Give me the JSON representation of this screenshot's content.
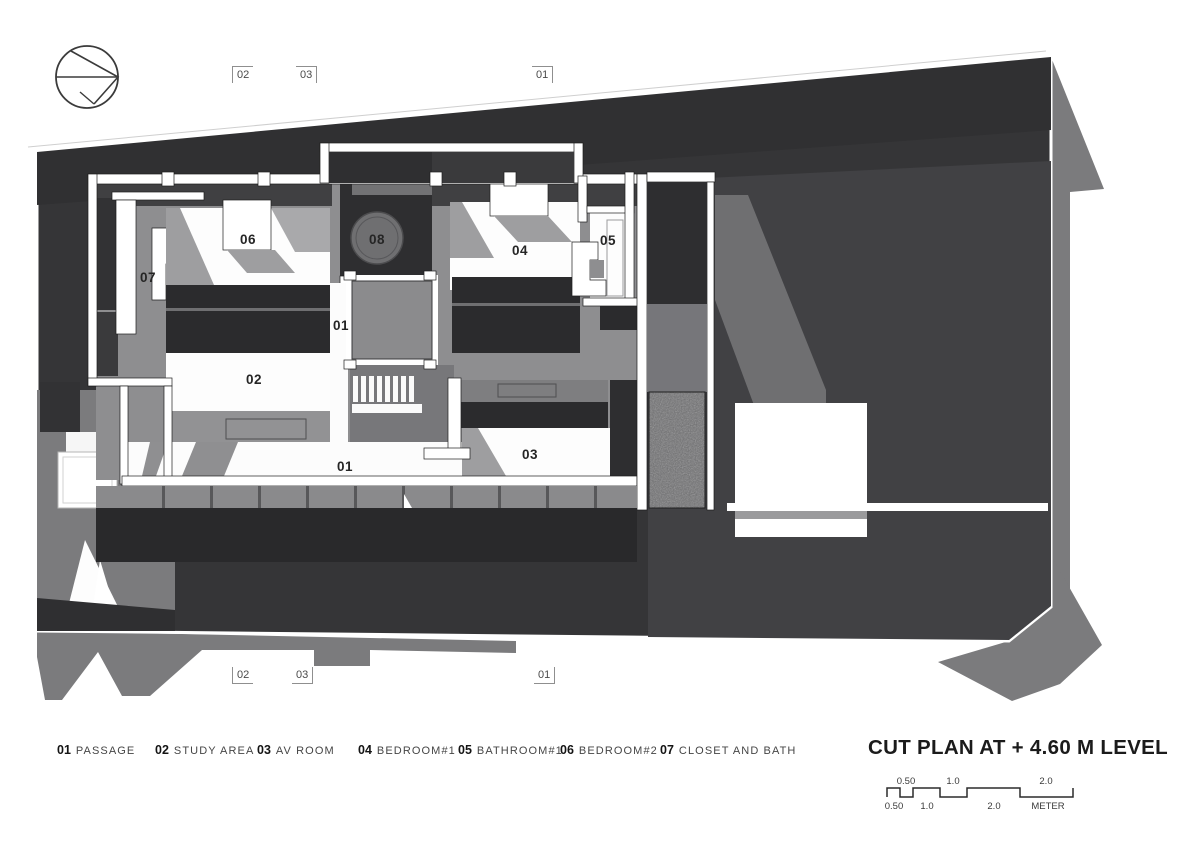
{
  "sheet": {
    "title": "CUT PLAN AT + 4.60 M LEVEL",
    "bg_color": "#ffffff"
  },
  "icons": {
    "north_arrow": "north-arrow-circle"
  },
  "section_markers": {
    "top": [
      {
        "label": "02"
      },
      {
        "label": "03"
      },
      {
        "label": "01"
      }
    ],
    "bottom": [
      {
        "label": "02"
      },
      {
        "label": "03"
      },
      {
        "label": "01"
      }
    ]
  },
  "plan": {
    "room_labels": [
      {
        "id": "06"
      },
      {
        "id": "08"
      },
      {
        "id": "07"
      },
      {
        "id": "04"
      },
      {
        "id": "05"
      },
      {
        "id": "01"
      },
      {
        "id": "02"
      },
      {
        "id": "01"
      },
      {
        "id": "03"
      }
    ]
  },
  "legend": {
    "items": [
      {
        "num": "01",
        "name": "PASSAGE"
      },
      {
        "num": "02",
        "name": "STUDY AREA"
      },
      {
        "num": "03",
        "name": "AV ROOM"
      },
      {
        "num": "04",
        "name": "BEDROOM#1"
      },
      {
        "num": "05",
        "name": "BATHROOM#1"
      },
      {
        "num": "06",
        "name": "BEDROOM#2"
      },
      {
        "num": "07",
        "name": "CLOSET AND BATH"
      }
    ]
  },
  "scale_bar": {
    "top_labels": [
      "0.50",
      "1.0",
      "2.0"
    ],
    "bottom_labels": [
      "0.50",
      "1.0",
      "2.0",
      "METER"
    ]
  },
  "colors": {
    "site_dark": "#353537",
    "site_top_band": "#303032",
    "roof_gray": "#414144",
    "shadow_gray": "#7b7b7d",
    "floor_gray": "#8e8e90",
    "mass_dark": "#2b2b2d",
    "wall_white": "#ffffff",
    "text_dark": "#252525"
  }
}
